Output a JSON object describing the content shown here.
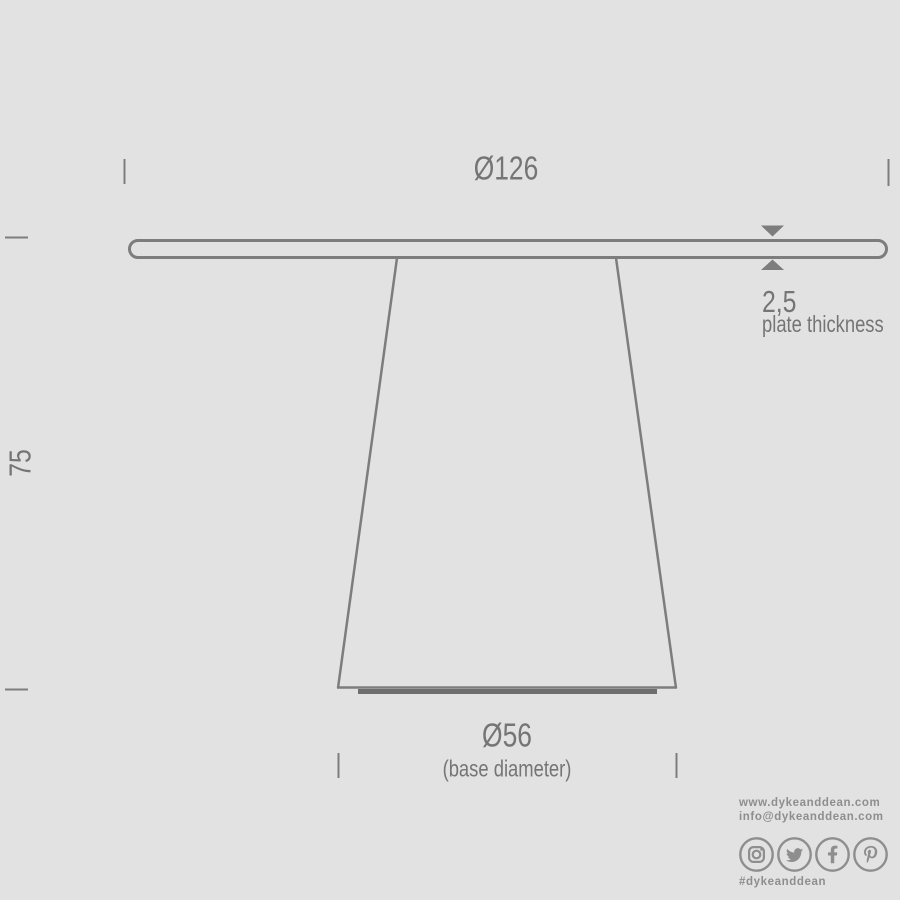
{
  "dimensions": {
    "top_diameter": "Ø126",
    "height": "75",
    "plate_thickness_value": "2,5",
    "plate_thickness_caption": "plate thickness",
    "base_diameter": "Ø56",
    "base_diameter_caption": "(base diameter)"
  },
  "footer": {
    "website": "www.dykeanddean.com",
    "email": "info@dykeanddean.com",
    "hashtag": "#dykeanddean",
    "social_icons": [
      "instagram",
      "twitter",
      "facebook",
      "pinterest"
    ]
  },
  "colors": {
    "background": "#e2e2e2",
    "line": "#7d7d7d",
    "dim_text": "#757575",
    "footer_text": "#8e8e8e"
  }
}
